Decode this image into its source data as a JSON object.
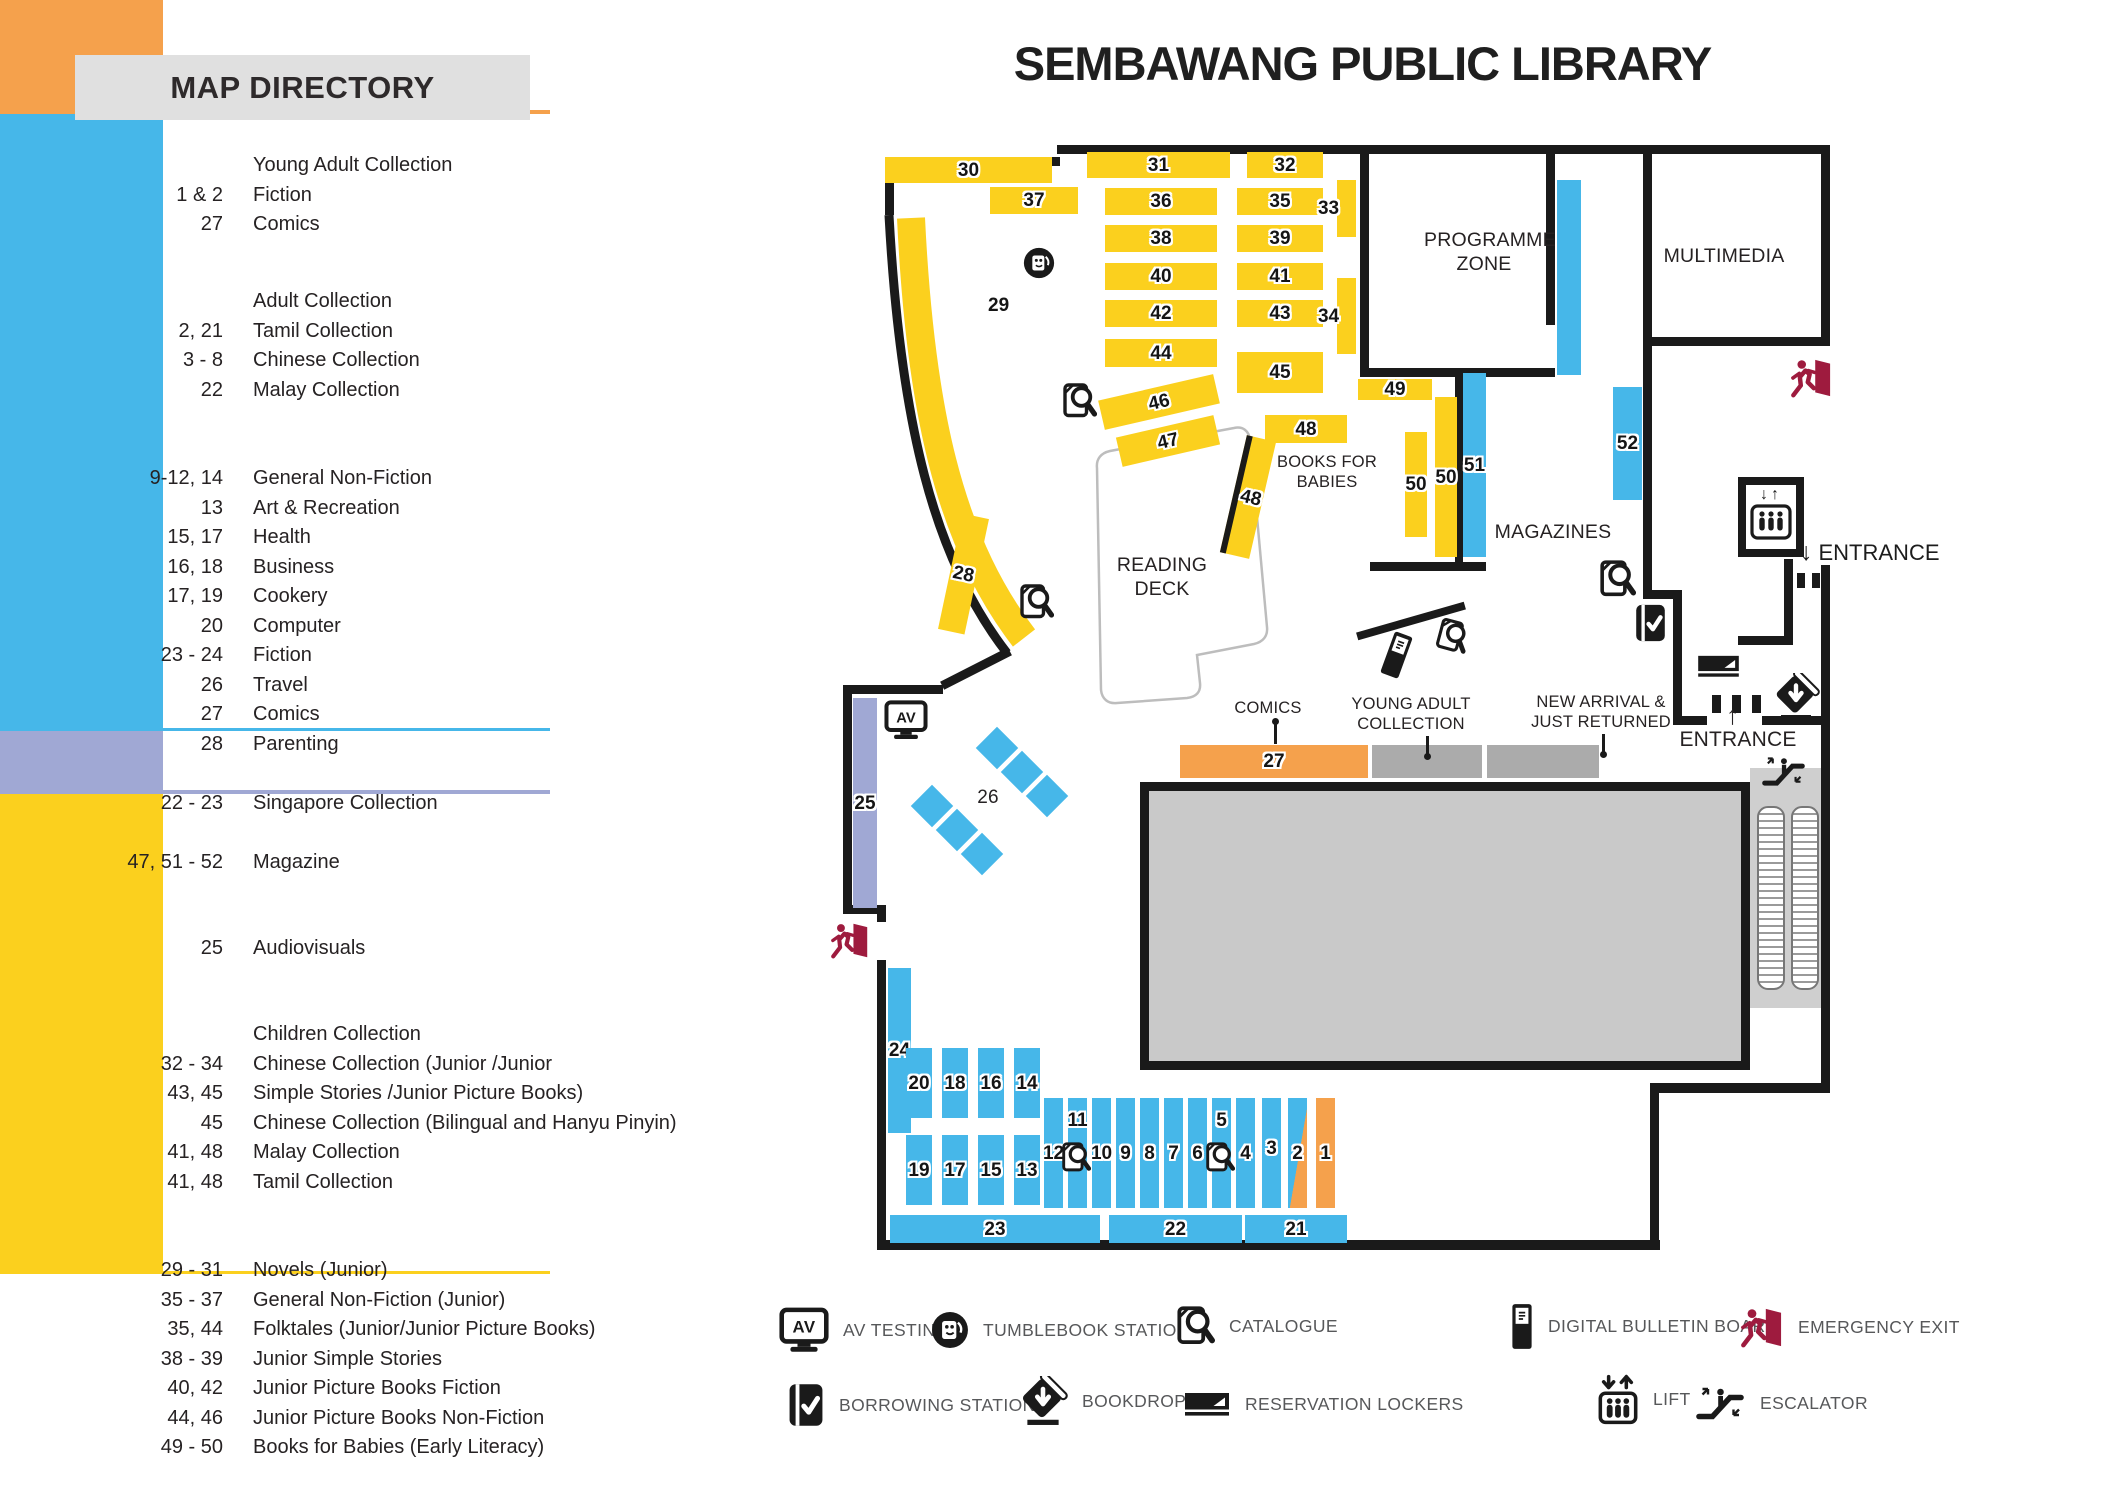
{
  "title": "SEMBAWANG PUBLIC LIBRARY",
  "directory": {
    "title": "MAP DIRECTORY",
    "sections": [
      {
        "name": "young-adult-collection",
        "color": "#F5A14C",
        "top": 148,
        "height": 110,
        "rows_top": 151,
        "rows": [
          {
            "num": "",
            "label": "Young Adult Collection"
          },
          {
            "num": "1 & 2",
            "label": "Fiction"
          },
          {
            "num": "27",
            "label": "Comics"
          }
        ]
      },
      {
        "name": "adult-collection",
        "color": "#46B7E9",
        "top": 283,
        "height": 614,
        "rows_top": 287,
        "rows": [
          {
            "num": "",
            "label": "Adult Collection"
          },
          {
            "num": "2, 21",
            "label": "Tamil Collection"
          },
          {
            "num": "3 - 8",
            "label": "Chinese Collection"
          },
          {
            "num": "22",
            "label": "Malay Collection"
          },
          {
            "sp": true
          },
          {
            "sp": true
          },
          {
            "num": "9-12, 14",
            "label": "General Non-Fiction"
          },
          {
            "num": "13",
            "label": "Art & Recreation"
          },
          {
            "num": "15, 17",
            "label": "Health"
          },
          {
            "num": "16, 18",
            "label": "Business"
          },
          {
            "num": "17, 19",
            "label": "Cookery"
          },
          {
            "num": "20",
            "label": "Computer"
          },
          {
            "num": "23 - 24",
            "label": "Fiction"
          },
          {
            "num": "26",
            "label": "Travel"
          },
          {
            "num": "27",
            "label": "Comics"
          },
          {
            "num": "28",
            "label": "Parenting"
          },
          {
            "sp": true
          },
          {
            "num": "22 - 23",
            "label": "Singapore Collection"
          },
          {
            "sp": true
          },
          {
            "num": "47, 51 - 52",
            "label": "Magazine"
          }
        ]
      },
      {
        "name": "audiovisuals",
        "color": "#A0A8D4",
        "top": 923,
        "height": 59,
        "rows_top": 934,
        "rows": [
          {
            "num": "25",
            "label": "Audiovisuals"
          }
        ]
      },
      {
        "name": "children-collection",
        "color": "#FBD01E",
        "top": 1008,
        "height": 477,
        "rows_top": 1020,
        "rows": [
          {
            "num": "",
            "label": "Children Collection"
          },
          {
            "num": "32 - 34",
            "label": "Chinese Collection (Junior /Junior"
          },
          {
            "num": "43, 45",
            "label": "Simple Stories /Junior Picture Books)"
          },
          {
            "num": "45",
            "label": "Chinese Collection (Bilingual and Hanyu Pinyin)"
          },
          {
            "num": "41, 48",
            "label": "Malay Collection"
          },
          {
            "num": "41, 48",
            "label": "Tamil Collection"
          },
          {
            "sp": true
          },
          {
            "sp": true
          },
          {
            "num": "29 - 31",
            "label": "Novels (Junior)"
          },
          {
            "num": "35 - 37",
            "label": "General Non-Fiction (Junior)"
          },
          {
            "num": "35, 44",
            "label": "Folktales (Junior/Junior Picture Books)"
          },
          {
            "num": "38 - 39",
            "label": "Junior Simple Stories"
          },
          {
            "num": "40, 42",
            "label": "Junior Picture Books Fiction"
          },
          {
            "num": "44, 46",
            "label": "Junior Picture Books Non-Fiction"
          },
          {
            "num": "49 - 50",
            "label": "Books for Babies (Early Literacy)"
          }
        ]
      }
    ]
  },
  "map": {
    "colors": {
      "Y": "#FBD01E",
      "B": "#46B7E9",
      "O": "#F5A14C",
      "P": "#A0A8D4",
      "G": "#ABABAB",
      "wall": "#1a1a1a",
      "maroon": "#9E1B3E",
      "block": "#C9C9C9"
    },
    "labels": {
      "programme_zone": "PROGRAMME ZONE",
      "multimedia": "MULTIMEDIA",
      "reading_deck": "READING DECK",
      "magazines": "MAGAZINES",
      "books_for_babies": "BOOKS FOR BABIES",
      "comics": "COMICS",
      "young_adult": "YOUNG ADULT COLLECTION",
      "new_arrival": "NEW ARRIVAL & JUST RETURNED",
      "entrance_top": "ENTRANCE",
      "entrance_bottom": "ENTRANCE",
      "arrow_down": "↓",
      "arrow_up": "↑",
      "av": "AV",
      "shelf26": "26",
      "shelf29": "29"
    },
    "walls": [
      [
        885,
        157,
        175,
        9
      ],
      [
        1057,
        145,
        773,
        9
      ],
      [
        885,
        157,
        9,
        58
      ],
      [
        1821,
        145,
        9,
        201
      ],
      [
        1643,
        145,
        9,
        454
      ],
      [
        1643,
        337,
        187,
        9
      ],
      [
        1360,
        145,
        9,
        232
      ],
      [
        1360,
        368,
        195,
        9
      ],
      [
        1546,
        145,
        9,
        180
      ],
      [
        1455,
        373,
        8,
        197
      ],
      [
        1370,
        562,
        116,
        9
      ],
      [
        1643,
        590,
        38,
        9
      ],
      [
        1673,
        590,
        9,
        135
      ],
      [
        1673,
        716,
        34,
        9
      ],
      [
        1762,
        716,
        68,
        9
      ],
      [
        1784,
        559,
        9,
        85
      ],
      [
        1738,
        636,
        55,
        9
      ],
      [
        1821,
        565,
        9,
        527
      ],
      [
        1650,
        1083,
        180,
        10
      ],
      [
        1650,
        1083,
        9,
        167
      ],
      [
        877,
        1240,
        783,
        10
      ],
      [
        877,
        905,
        9,
        17
      ],
      [
        877,
        960,
        9,
        290
      ],
      [
        843,
        905,
        43,
        9
      ],
      [
        843,
        685,
        9,
        229
      ],
      [
        843,
        685,
        100,
        9
      ],
      [
        938,
        664,
        76,
        9,
        -27
      ],
      [
        1355,
        617,
        112,
        8,
        -16
      ]
    ],
    "shelves": [
      {
        "label": "30",
        "x": 885,
        "y": 157,
        "w": 167,
        "h": 26,
        "c": "Y"
      },
      {
        "label": "31",
        "x": 1087,
        "y": 152,
        "w": 143,
        "h": 26,
        "c": "Y"
      },
      {
        "label": "32",
        "x": 1247,
        "y": 152,
        "w": 76,
        "h": 26,
        "c": "Y"
      },
      {
        "label": "37",
        "x": 990,
        "y": 187,
        "w": 88,
        "h": 27,
        "c": "Y"
      },
      {
        "label": "36",
        "x": 1105,
        "y": 188,
        "w": 112,
        "h": 27,
        "c": "Y"
      },
      {
        "label": "35",
        "x": 1237,
        "y": 188,
        "w": 86,
        "h": 27,
        "c": "Y"
      },
      {
        "label": "33",
        "x": 1337,
        "y": 180,
        "w": 19,
        "h": 57,
        "c": "Y",
        "ldx": -18
      },
      {
        "label": "38",
        "x": 1105,
        "y": 225,
        "w": 112,
        "h": 27,
        "c": "Y"
      },
      {
        "label": "39",
        "x": 1237,
        "y": 225,
        "w": 86,
        "h": 27,
        "c": "Y"
      },
      {
        "label": "40",
        "x": 1105,
        "y": 263,
        "w": 112,
        "h": 27,
        "c": "Y"
      },
      {
        "label": "41",
        "x": 1237,
        "y": 263,
        "w": 86,
        "h": 27,
        "c": "Y"
      },
      {
        "label": "42",
        "x": 1105,
        "y": 300,
        "w": 112,
        "h": 27,
        "c": "Y"
      },
      {
        "label": "43",
        "x": 1237,
        "y": 300,
        "w": 86,
        "h": 27,
        "c": "Y"
      },
      {
        "label": "34",
        "x": 1337,
        "y": 278,
        "w": 19,
        "h": 76,
        "c": "Y",
        "ldx": -18
      },
      {
        "label": "44",
        "x": 1105,
        "y": 339,
        "w": 112,
        "h": 28,
        "c": "Y"
      },
      {
        "label": "45",
        "x": 1237,
        "y": 352,
        "w": 86,
        "h": 41,
        "c": "Y"
      },
      {
        "label": "46",
        "x": 1100,
        "y": 387,
        "w": 118,
        "h": 30,
        "c": "Y",
        "rot": -13
      },
      {
        "label": "47",
        "x": 1118,
        "y": 426,
        "w": 100,
        "h": 30,
        "c": "Y",
        "rot": -13
      },
      {
        "label": "48",
        "x": 1265,
        "y": 415,
        "w": 82,
        "h": 28,
        "c": "Y"
      },
      {
        "label": "48",
        "x": 1233,
        "y": 437,
        "w": 30,
        "h": 120,
        "c": "Y",
        "rot": 13,
        "wl": true
      },
      {
        "label": "28",
        "x": 950,
        "y": 515,
        "w": 27,
        "h": 118,
        "c": "Y",
        "rot": 12
      },
      {
        "label": "49",
        "x": 1358,
        "y": 379,
        "w": 74,
        "h": 21,
        "c": "Y"
      },
      {
        "label": "50",
        "x": 1405,
        "y": 432,
        "w": 22,
        "h": 105,
        "c": "Y"
      },
      {
        "label": "50",
        "x": 1435,
        "y": 397,
        "w": 22,
        "h": 160,
        "c": "Y"
      },
      {
        "label": "51",
        "x": 1463,
        "y": 373,
        "w": 23,
        "h": 184,
        "c": "B"
      },
      {
        "label": "52",
        "x": 1613,
        "y": 387,
        "w": 29,
        "h": 113,
        "c": "B"
      },
      {
        "label": "",
        "x": 1557,
        "y": 180,
        "w": 24,
        "h": 195,
        "c": "B"
      },
      {
        "label": "25",
        "x": 853,
        "y": 698,
        "w": 24,
        "h": 210,
        "c": "P"
      },
      {
        "label": "24",
        "x": 888,
        "y": 968,
        "w": 23,
        "h": 165,
        "c": "B"
      },
      {
        "label": "20",
        "x": 906,
        "y": 1048,
        "w": 26,
        "h": 70,
        "c": "B"
      },
      {
        "label": "18",
        "x": 942,
        "y": 1048,
        "w": 26,
        "h": 70,
        "c": "B"
      },
      {
        "label": "16",
        "x": 978,
        "y": 1048,
        "w": 26,
        "h": 70,
        "c": "B"
      },
      {
        "label": "14",
        "x": 1014,
        "y": 1048,
        "w": 26,
        "h": 70,
        "c": "B"
      },
      {
        "label": "19",
        "x": 906,
        "y": 1135,
        "w": 26,
        "h": 70,
        "c": "B"
      },
      {
        "label": "17",
        "x": 942,
        "y": 1135,
        "w": 26,
        "h": 70,
        "c": "B"
      },
      {
        "label": "15",
        "x": 978,
        "y": 1135,
        "w": 26,
        "h": 70,
        "c": "B"
      },
      {
        "label": "13",
        "x": 1014,
        "y": 1135,
        "w": 26,
        "h": 70,
        "c": "B"
      },
      {
        "label": "12",
        "x": 1044,
        "y": 1098,
        "w": 19,
        "h": 110,
        "c": "B"
      },
      {
        "label": "11",
        "x": 1068,
        "y": 1098,
        "w": 19,
        "h": 110,
        "c": "B",
        "ldy": -33
      },
      {
        "label": "10",
        "x": 1092,
        "y": 1098,
        "w": 19,
        "h": 110,
        "c": "B"
      },
      {
        "label": "9",
        "x": 1116,
        "y": 1098,
        "w": 19,
        "h": 110,
        "c": "B"
      },
      {
        "label": "8",
        "x": 1140,
        "y": 1098,
        "w": 19,
        "h": 110,
        "c": "B"
      },
      {
        "label": "7",
        "x": 1164,
        "y": 1098,
        "w": 19,
        "h": 110,
        "c": "B"
      },
      {
        "label": "6",
        "x": 1188,
        "y": 1098,
        "w": 19,
        "h": 110,
        "c": "B"
      },
      {
        "label": "5",
        "x": 1212,
        "y": 1098,
        "w": 19,
        "h": 110,
        "c": "B",
        "ldy": -33
      },
      {
        "label": "4",
        "x": 1236,
        "y": 1098,
        "w": 19,
        "h": 110,
        "c": "B"
      },
      {
        "label": "3",
        "x": 1262,
        "y": 1098,
        "w": 19,
        "h": 110,
        "c": "B",
        "ldy": -5
      },
      {
        "label": "2",
        "x": 1288,
        "y": 1098,
        "w": 19,
        "h": 110,
        "c": "BO"
      },
      {
        "label": "1",
        "x": 1316,
        "y": 1098,
        "w": 19,
        "h": 110,
        "c": "O"
      },
      {
        "label": "23",
        "x": 890,
        "y": 1215,
        "w": 210,
        "h": 28,
        "c": "B"
      },
      {
        "label": "22",
        "x": 1109,
        "y": 1215,
        "w": 133,
        "h": 28,
        "c": "B"
      },
      {
        "label": "21",
        "x": 1245,
        "y": 1215,
        "w": 102,
        "h": 28,
        "c": "B"
      },
      {
        "label": "27",
        "x": 1180,
        "y": 745,
        "w": 188,
        "h": 33,
        "c": "O"
      },
      {
        "label": "",
        "x": 1372,
        "y": 745,
        "w": 110,
        "h": 33,
        "c": "G"
      },
      {
        "label": "",
        "x": 1487,
        "y": 745,
        "w": 112,
        "h": 33,
        "c": "G"
      }
    ],
    "diamonds": [
      [
        997,
        748
      ],
      [
        1022,
        772
      ],
      [
        1047,
        796
      ],
      [
        932,
        806
      ],
      [
        957,
        830
      ],
      [
        982,
        854
      ]
    ],
    "gates": [
      {
        "x": 1712,
        "y": 695,
        "w": 9,
        "h": 18
      },
      {
        "x": 1732,
        "y": 695,
        "w": 9,
        "h": 18
      },
      {
        "x": 1752,
        "y": 695,
        "w": 9,
        "h": 18
      },
      {
        "x": 1797,
        "y": 573,
        "w": 8,
        "h": 15
      },
      {
        "x": 1812,
        "y": 573,
        "w": 8,
        "h": 15
      }
    ],
    "pointers": [
      {
        "x": 1274,
        "y": 724,
        "h": 20,
        "dot": "top"
      },
      {
        "x": 1426,
        "y": 736,
        "h": 18,
        "dot": "bot"
      },
      {
        "x": 1602,
        "y": 734,
        "h": 18,
        "dot": "bot"
      }
    ],
    "icons": [
      {
        "t": "tumblebook",
        "x": 1023,
        "y": 247,
        "s": 32
      },
      {
        "t": "catalogue",
        "x": 1063,
        "y": 383,
        "s": 34
      },
      {
        "t": "catalogue",
        "x": 1020,
        "y": 584,
        "s": 34
      },
      {
        "t": "catalogue",
        "x": 1600,
        "y": 560,
        "s": 36
      },
      {
        "t": "catalogue",
        "x": 1438,
        "y": 620,
        "s": 31,
        "rot": 15
      },
      {
        "t": "kiosk",
        "x": 1385,
        "y": 632,
        "s": 46,
        "rot": 20
      },
      {
        "t": "catalogue",
        "x": 1062,
        "y": 1142,
        "s": 29
      },
      {
        "t": "catalogue",
        "x": 1206,
        "y": 1142,
        "s": 29
      },
      {
        "t": "av",
        "x": 884,
        "y": 700,
        "s": 44
      },
      {
        "t": "exit",
        "x": 830,
        "y": 922,
        "s": 40
      },
      {
        "t": "exit",
        "x": 1790,
        "y": 358,
        "s": 43
      },
      {
        "t": "borrow",
        "x": 1634,
        "y": 603,
        "s": 40
      },
      {
        "t": "lockers",
        "x": 1696,
        "y": 654,
        "s": 45
      },
      {
        "t": "bookdrop",
        "x": 1772,
        "y": 673,
        "s": 48
      },
      {
        "t": "liftbox",
        "x": 1738,
        "y": 477,
        "s": 80
      },
      {
        "t": "escalator",
        "x": 1760,
        "y": 754,
        "s": 47
      }
    ]
  },
  "legend": {
    "items": [
      {
        "icon": "av",
        "x": 779,
        "y": 1307,
        "s": 50,
        "label": "AV TESTING"
      },
      {
        "icon": "tumblebook",
        "x": 931,
        "y": 1311,
        "s": 38,
        "label": "TUMBLEBOOK STATION"
      },
      {
        "icon": "catalogue",
        "x": 1177,
        "y": 1306,
        "s": 38,
        "label": "CATALOGUE"
      },
      {
        "icon": "kiosk",
        "x": 1510,
        "y": 1303,
        "s": 47,
        "label": "DIGITAL BULLETIN BOARD"
      },
      {
        "icon": "exit",
        "x": 1740,
        "y": 1307,
        "s": 44,
        "label": "EMERGENCY EXIT"
      },
      {
        "icon": "borrow",
        "x": 787,
        "y": 1382,
        "s": 46,
        "label": "BORROWING STATION"
      },
      {
        "icon": "bookdrop",
        "x": 1018,
        "y": 1376,
        "s": 50,
        "label": "BOOKDROP"
      },
      {
        "icon": "lockers",
        "x": 1183,
        "y": 1391,
        "s": 48,
        "label": "RESERVATION LOCKERS"
      },
      {
        "icon": "lift",
        "x": 1597,
        "y": 1373,
        "s": 52,
        "label": "LIFT"
      },
      {
        "icon": "escalator",
        "x": 1694,
        "y": 1384,
        "s": 52,
        "label": "ESCALATOR"
      }
    ]
  }
}
